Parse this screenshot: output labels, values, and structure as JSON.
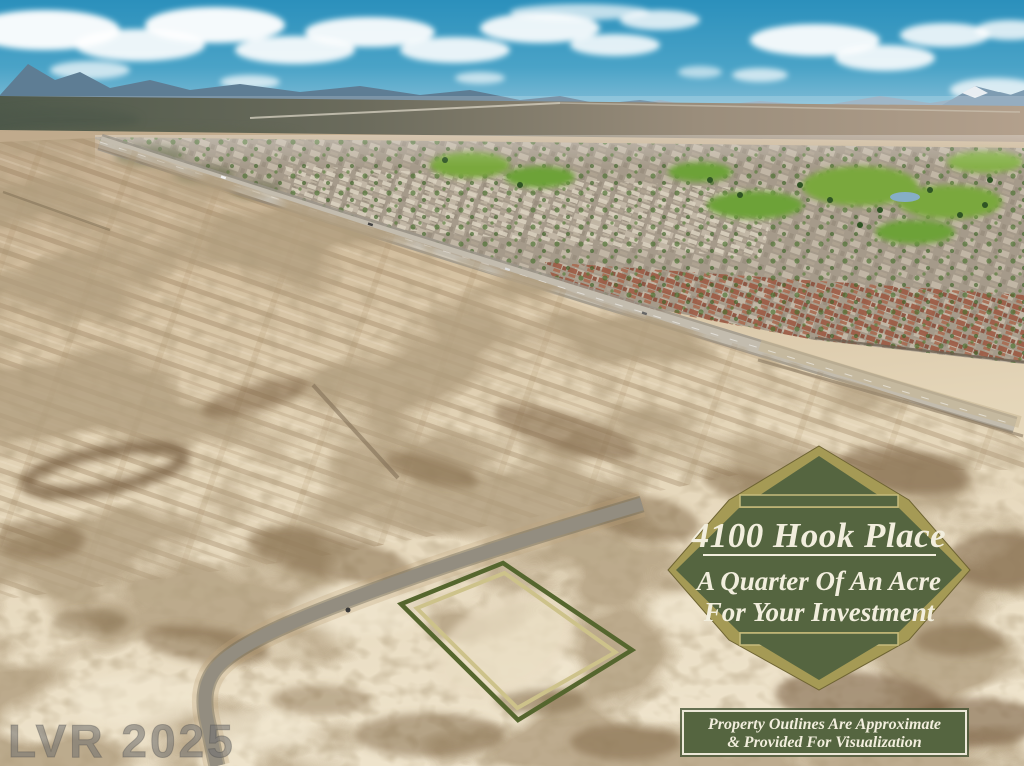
{
  "photo": {
    "watermark": "LVR 2025",
    "colors": {
      "sky_top": "#2b90bc",
      "sky_horizon": "#c6dde9",
      "mountain_far": "#8aa7bb",
      "mountain_near": "#5e7d94",
      "desert_sand": "#e4d5b8",
      "scrub_brown": "#7b6142",
      "road_gray": "#938d80",
      "golf_green": "#7aa83e"
    }
  },
  "badge": {
    "address": "4100 Hook Place",
    "line1": "A Quarter Of An Acre",
    "line2": "For Your Investment",
    "colors": {
      "gold": "#a59a55",
      "green": "#556540",
      "text": "#f2eedd"
    }
  },
  "disclaimer": {
    "line1": "Property Outlines Are Approximate",
    "line2": "& Provided For Visualization"
  },
  "property_outline_colors": {
    "outer": "#55662e",
    "inner": "#cdc28a"
  }
}
